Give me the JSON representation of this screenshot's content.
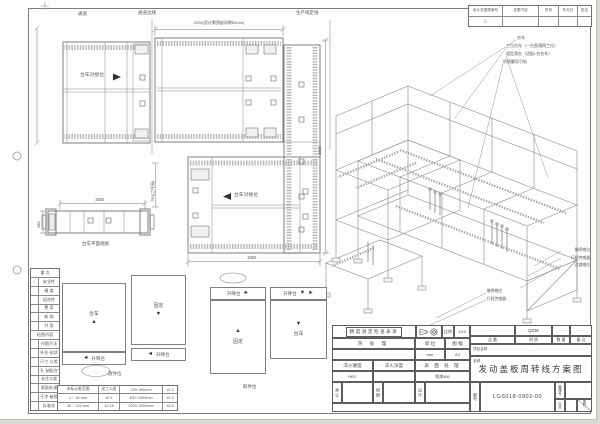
{
  "colors": {
    "paper": "#fdfdfc",
    "line": "#6a6a6a",
    "roller": "#b5b5b5"
  },
  "top_plan": {
    "aisle_label": "通道",
    "aisle_edge_label": "通道边线",
    "dim_2200": "2200(设计需预留间隙50mm)",
    "production_line_label": "生产线定线",
    "dock_label_top": "台车对接位",
    "dock_label_lower": "台车对接位",
    "dim_3800": "3800",
    "dim_1650": "1650"
  },
  "trolley_view": {
    "dim_1500": "1500",
    "dim_380": "380",
    "dim_750": "750(工作高)",
    "caption": "台车平面视图"
  },
  "iso_view": {
    "callouts_top": [
      "台车",
      "工位台车（一台直通两工位）",
      "固定滑台（适配L台台车）",
      "防侧翻导引轨"
    ],
    "callouts_right": [
      "触停感应",
      "行程传感器",
      "过渡感应"
    ],
    "callouts_bottom": [
      "触停感应",
      "行程传感器"
    ]
  },
  "revision_table": {
    "headers": [
      "设计变更提案号",
      "变更内容",
      "符号",
      "年月日",
      "姓名"
    ],
    "row": [
      "△",
      "·",
      "·",
      "·",
      "·"
    ]
  },
  "position_diagrams": {
    "caption_left": "放件位",
    "caption_right": "取件位",
    "lift_label": "升降台",
    "d1_box": "台车",
    "d2_box": "固定",
    "d3_box": "固定",
    "d4_box": "台车"
  },
  "checklist": {
    "rows": [
      {
        "mark": "",
        "label": "重  点"
      },
      {
        "mark": "○",
        "label": "安全性"
      },
      {
        "mark": "",
        "label": "精 度"
      },
      {
        "mark": "",
        "label": "组合性"
      },
      {
        "mark": "",
        "label": "费 用"
      },
      {
        "mark": "",
        "label": "新 规"
      },
      {
        "mark": "",
        "label": "共 用"
      },
      {
        "mark": "",
        "label": "检图内容"
      },
      {
        "mark": "",
        "label": "作图方法"
      },
      {
        "mark": "",
        "label": "外形·形状"
      },
      {
        "mark": "",
        "label": "尺寸·公差"
      },
      {
        "mark": "",
        "label": "孔·轴配合"
      },
      {
        "mark": "",
        "label": "未注公差"
      },
      {
        "mark": "",
        "label": "表面处理"
      },
      {
        "mark": "",
        "label": "干涉·破损"
      },
      {
        "mark": "",
        "label": "标准化"
      }
    ]
  },
  "tolerance_table": {
    "rows": [
      [
        "未标公差范围",
        "加工公差",
        "120~400mm",
        "±0.2"
      ],
      [
        "1 ~ 30 mm",
        "±0.1",
        "400~1000mm",
        "±0.3"
      ],
      [
        "30 ~ 120 mm",
        "±0.15",
        "1000~2000mm",
        "±0.5"
      ]
    ]
  },
  "title_block": {
    "banner": "精度测定检查表单",
    "scale_label": "比例",
    "scale_value": "1/10",
    "heat_label": "热 处 理",
    "unit_label": "单 位",
    "unit_value": "mm",
    "format_label": "图 幅",
    "format_value": "A3",
    "hardness_label": "淬火硬度",
    "hardness_value": "HRC",
    "depth_label": "淬火深度",
    "depth_value": "·",
    "surface_label": "表 面 处 理",
    "surface_value": "喷漆480",
    "part_label": "品 番",
    "part_value": "·",
    "material_label": "材 质",
    "material_value": "Q235",
    "qty_label": "数 量",
    "qty_value": "·",
    "remark_label": "备 注",
    "remark_value": "·",
    "project_label": "项目名称",
    "project_value": "·",
    "name_label": "名称",
    "drawing_title": "发动盖板周转线方案图",
    "approve_label": "承 认",
    "check_label": "校 图",
    "design_label": "设 计",
    "footer_value": "·",
    "dwgno_label": "图号",
    "dwgno_value": "LGS018-0902-00",
    "mgmt_label": "管理号",
    "mgmt_value": "·",
    "class_label": "区分",
    "class_value": "·",
    "code_label": "图码"
  }
}
